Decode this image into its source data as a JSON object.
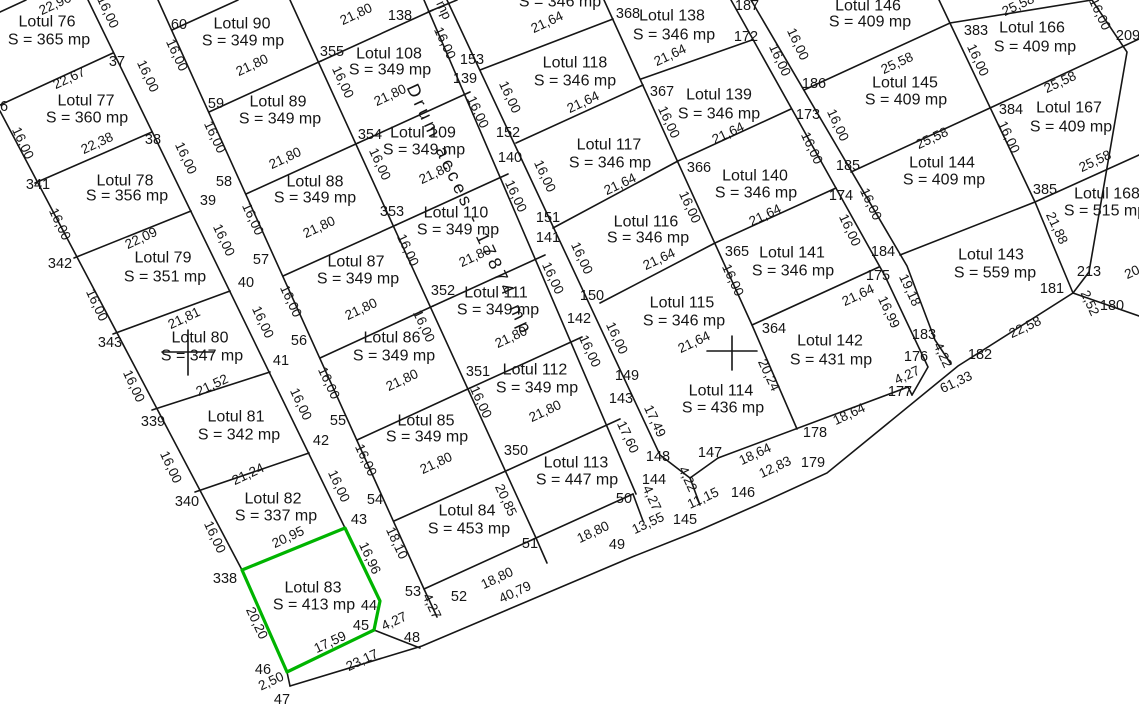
{
  "plan": {
    "road_label": "Drum acces - 17874 mp",
    "highlight_color": "#00b400",
    "partial_top_area": "S = 346 mp",
    "selected_lot": "Lotul 83"
  },
  "lots": [
    {
      "name": "Lotul 76",
      "area": "S = 365 mp"
    },
    {
      "name": "Lotul 77",
      "area": "S = 360 mp"
    },
    {
      "name": "Lotul 78",
      "area": "S = 356 mp"
    },
    {
      "name": "Lotul 79",
      "area": "S = 351 mp"
    },
    {
      "name": "Lotul 80",
      "area": "S = 347 mp"
    },
    {
      "name": "Lotul 81",
      "area": "S = 342 mp"
    },
    {
      "name": "Lotul 82",
      "area": "S = 337 mp"
    },
    {
      "name": "Lotul 83",
      "area": "S = 413 mp"
    },
    {
      "name": "Lotul 84",
      "area": "S = 453 mp"
    },
    {
      "name": "Lotul 85",
      "area": "S = 349 mp"
    },
    {
      "name": "Lotul 86",
      "area": "S = 349 mp"
    },
    {
      "name": "Lotul 87",
      "area": "S = 349 mp"
    },
    {
      "name": "Lotul 88",
      "area": "S = 349 mp"
    },
    {
      "name": "Lotul 89",
      "area": "S = 349 mp"
    },
    {
      "name": "Lotul 90",
      "area": "S = 349 mp"
    },
    {
      "name": "Lotul 108",
      "area": "S = 349 mp"
    },
    {
      "name": "Lotul 109",
      "area": "S = 349 mp"
    },
    {
      "name": "Lotul 110",
      "area": "S = 349 mp"
    },
    {
      "name": "Lotul 111",
      "area": "S = 349 mp"
    },
    {
      "name": "Lotul 112",
      "area": "S = 349 mp"
    },
    {
      "name": "Lotul 113",
      "area": "S = 447 mp"
    },
    {
      "name": "Lotul 114",
      "area": "S = 436 mp"
    },
    {
      "name": "Lotul 115",
      "area": "S = 346 mp"
    },
    {
      "name": "Lotul 116",
      "area": "S = 346 mp"
    },
    {
      "name": "Lotul 117",
      "area": "S = 346 mp"
    },
    {
      "name": "Lotul 118",
      "area": "S = 346 mp"
    },
    {
      "name": "Lotul 138",
      "area": "S = 346 mp"
    },
    {
      "name": "Lotul 139",
      "area": "S = 346 mp"
    },
    {
      "name": "Lotul 140",
      "area": "S = 346 mp"
    },
    {
      "name": "Lotul 141",
      "area": "S = 346 mp"
    },
    {
      "name": "Lotul 142",
      "area": "S = 431 mp"
    },
    {
      "name": "Lotul 143",
      "area": "S = 559 mp"
    },
    {
      "name": "Lotul 144",
      "area": "S = 409 mp"
    },
    {
      "name": "Lotul 145",
      "area": "S = 409 mp"
    },
    {
      "name": "Lotul 146",
      "area": "S = 409 mp"
    },
    {
      "name": "Lotul 166",
      "area": "S = 409 mp"
    },
    {
      "name": "Lotul 167",
      "area": "S = 409 mp"
    },
    {
      "name": "Lotul 168",
      "area": "S = 515 mp"
    }
  ],
  "points": [
    "37",
    "38",
    "39",
    "40",
    "41",
    "42",
    "43",
    "44",
    "45",
    "46",
    "47",
    "48",
    "49",
    "50",
    "51",
    "52",
    "53",
    "54",
    "55",
    "56",
    "57",
    "58",
    "59",
    "60",
    "138",
    "139",
    "140",
    "141",
    "142",
    "143",
    "144",
    "145",
    "146",
    "147",
    "148",
    "149",
    "150",
    "151",
    "152",
    "153",
    "172",
    "173",
    "174",
    "175",
    "176",
    "177",
    "178",
    "179",
    "180",
    "181",
    "182",
    "183",
    "184",
    "185",
    "186",
    "187",
    "209",
    "213",
    "338",
    "339",
    "340",
    "341",
    "342",
    "343",
    "350",
    "351",
    "352",
    "353",
    "354",
    "355",
    "364",
    "365",
    "366",
    "367",
    "368",
    "383",
    "384",
    "385",
    "6"
  ],
  "edges": [
    "22,96",
    "22,67",
    "22,38",
    "22,09",
    "21,81",
    "21,52",
    "21,24",
    "20,95",
    "17,59",
    "23,17",
    "2,50",
    "21,80",
    "21,80",
    "21,80",
    "21,80",
    "21,80",
    "21,80",
    "21,80",
    "21,80",
    "21,80",
    "21,80",
    "21,80",
    "21,80",
    "18,80",
    "18,80",
    "40,79",
    "21,64",
    "21,64",
    "21,64",
    "21,64",
    "21,64",
    "21,64",
    "21,64",
    "21,64",
    "21,64",
    "25,58",
    "25,58",
    "25,58",
    "25,58",
    "25,58",
    "18,64",
    "18,64",
    "13,55",
    "11,15",
    "12,83",
    "61,33",
    "22,58",
    "4,27",
    "4,27",
    "20",
    "16,00",
    "16,00",
    "16,00",
    "16,00",
    "16,00",
    "16,00",
    "16,00",
    "16,00",
    "16,00",
    "16,00",
    "16,00",
    "16,00",
    "16,00",
    "16,00",
    "16,00",
    "16,00",
    "16,00",
    "16,00",
    "16,00",
    "16,00",
    "16,00",
    "16,00",
    "16,00",
    "16,00",
    "16,00",
    "16,00",
    "16,00",
    "17,60",
    "17,49",
    "16,00",
    "16,00",
    "16,00",
    "20,24",
    "16,00",
    "16,00",
    "16,00",
    "16,99",
    "16,00",
    "16,00",
    "16,00",
    "19,18",
    "16,00",
    "16,00",
    "21,88",
    "16,00",
    "16,00",
    "16,00",
    "16,00",
    "16,00",
    "16,00",
    "16,00",
    "20,20",
    "16,96",
    "18,10",
    "20,85",
    "4,27",
    "4,27",
    "4,22",
    "4,22",
    "2,52",
    "mp"
  ]
}
